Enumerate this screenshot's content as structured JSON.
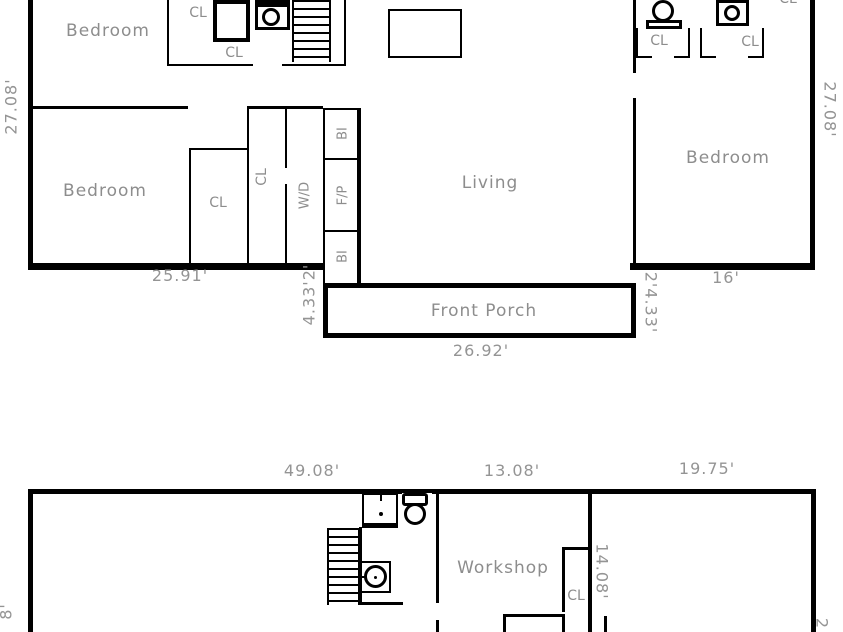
{
  "plan_upper": {
    "rooms": {
      "bedroom_tl": "Bedroom",
      "bedroom_bl": "Bedroom",
      "bedroom_r": "Bedroom",
      "living": "Living",
      "front_porch": "Front Porch"
    },
    "closets": {
      "cl_tl_upper": "CL",
      "cl_tl_lower": "CL",
      "cl_mid_vertical": "CL",
      "cl_bl": "CL",
      "cl_r1": "CL",
      "cl_r2": "CL",
      "cl_tr_partial": "CL"
    },
    "features": {
      "bi_top": "BI",
      "fireplace": "F/P",
      "bi_bottom": "BI",
      "washer_dryer": "W/D"
    },
    "dimensions": {
      "left_height": "27.08'",
      "right_height": "27.08'",
      "left_width": "25.91'",
      "porch_width": "26.92'",
      "right_width": "16'",
      "porch_side_left": "4.33'2'",
      "porch_side_right": "2'4.33'"
    }
  },
  "plan_lower": {
    "rooms": {
      "workshop": "Workshop"
    },
    "closets": {
      "cl_workshop": "CL"
    },
    "dimensions": {
      "top_left": "49.08'",
      "top_mid": "13.08'",
      "top_right": "19.75'",
      "interior_height": "14.08'",
      "left_edge_partial": "8'",
      "right_edge_partial": "2"
    }
  }
}
